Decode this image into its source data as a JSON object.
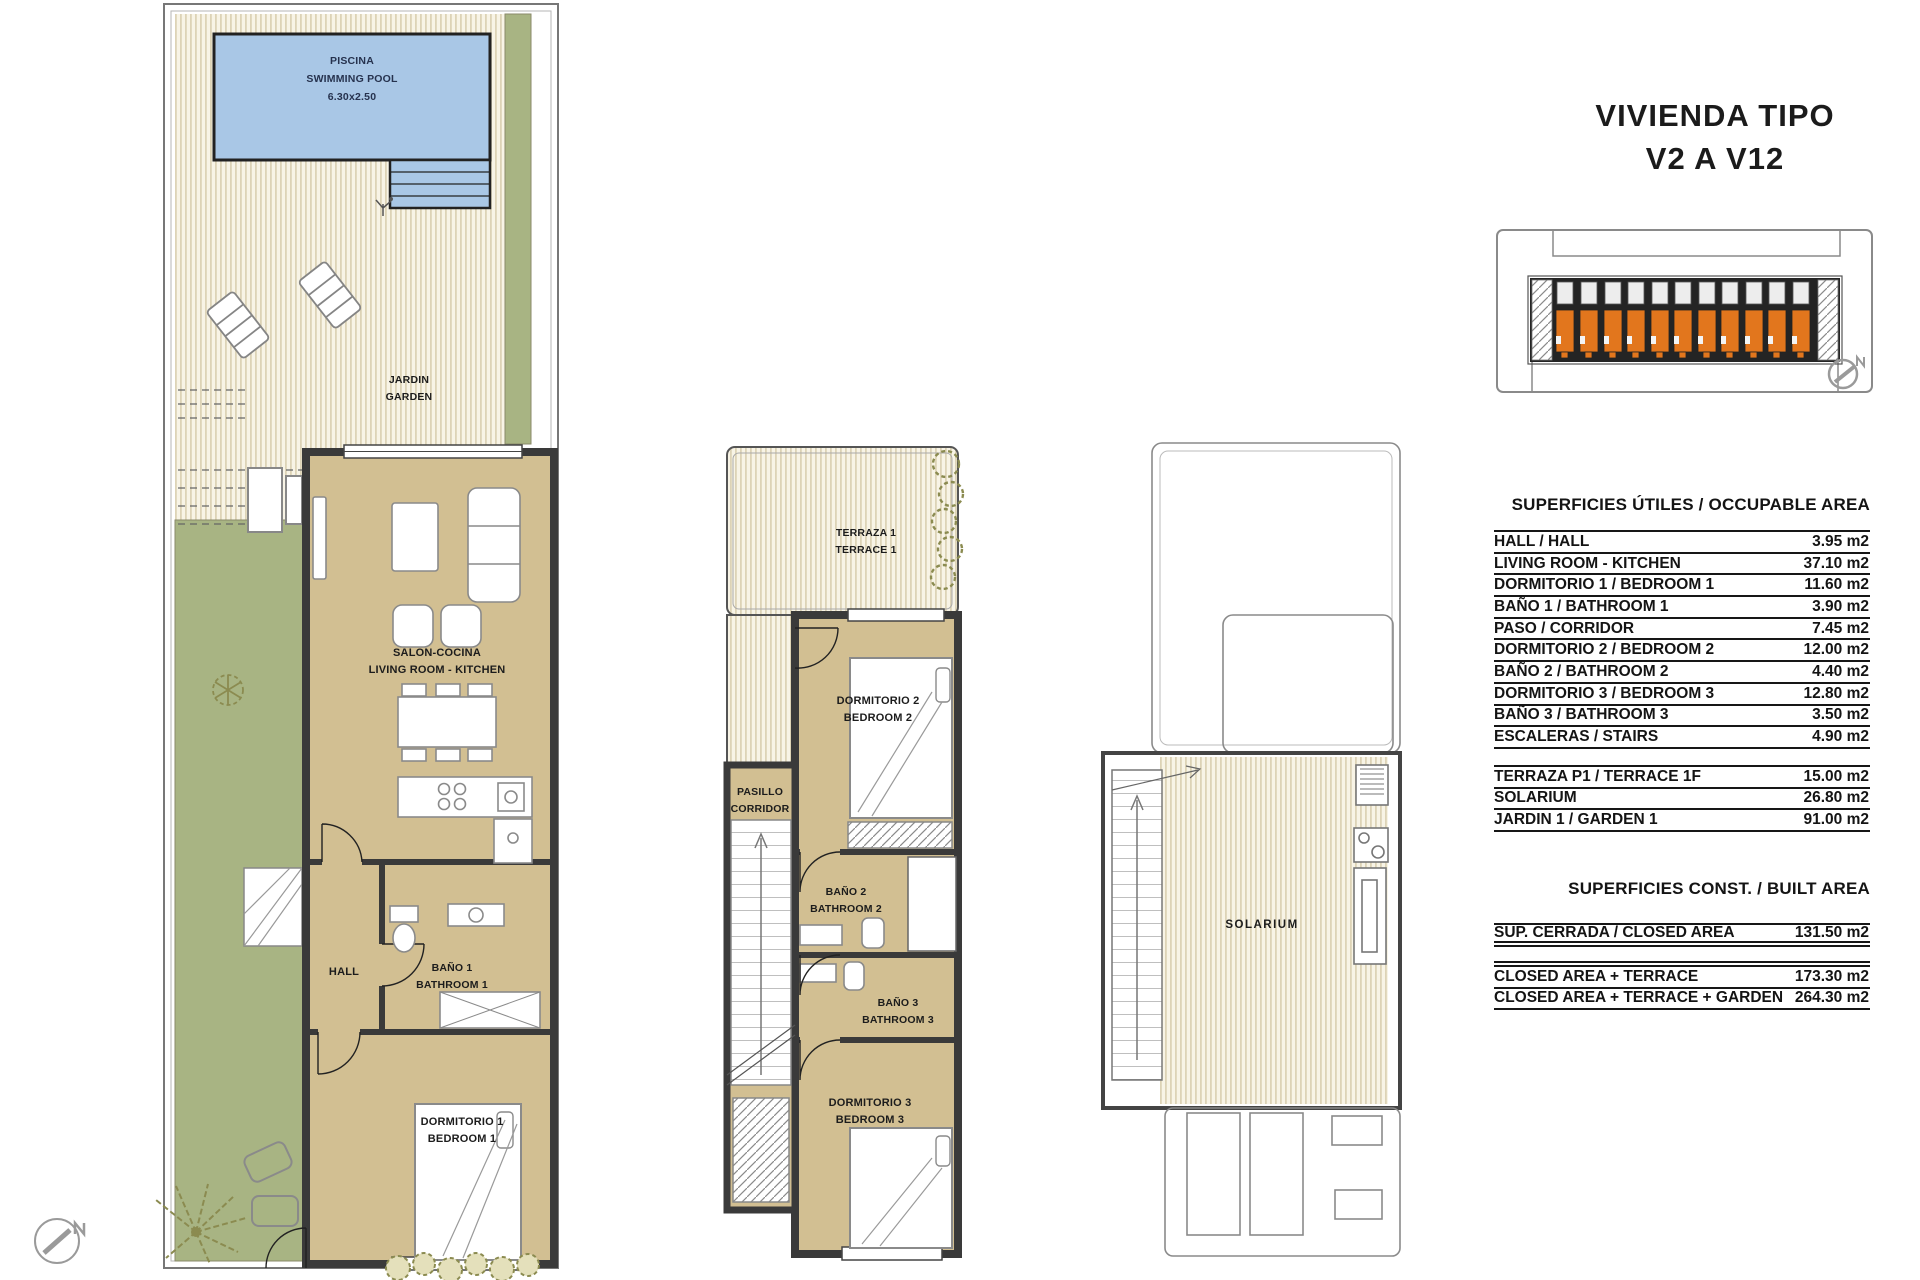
{
  "title": {
    "line1": "VIVIENDA TIPO",
    "line2": "V2 A V12"
  },
  "colors": {
    "floor_tan": "#d2bf92",
    "garden_green": "#a8b483",
    "stripe_cream": "#f8f4e6",
    "pool_blue": "#a9c7e6",
    "unit_orange": "#e2761d",
    "wall_dark": "#3a3a3a"
  },
  "plans": {
    "ground": {
      "pool": {
        "l1": "PISCINA",
        "l2": "SWIMMING POOL",
        "l3": "6.30x2.50"
      },
      "garden": {
        "l1": "JARDIN",
        "l2": "GARDEN"
      },
      "living": {
        "l1": "SALON-COCINA",
        "l2": "LIVING ROOM - KITCHEN"
      },
      "hall": "HALL",
      "bath1": {
        "l1": "BAÑO 1",
        "l2": "BATHROOM 1"
      },
      "bedroom1": {
        "l1": "DORMITORIO 1",
        "l2": "BEDROOM 1"
      }
    },
    "first": {
      "terrace": {
        "l1": "TERRAZA 1",
        "l2": "TERRACE 1"
      },
      "corridor": {
        "l1": "PASILLO",
        "l2": "CORRIDOR"
      },
      "bedroom2": {
        "l1": "DORMITORIO 2",
        "l2": "BEDROOM 2"
      },
      "bath2": {
        "l1": "BAÑO 2",
        "l2": "BATHROOM 2"
      },
      "bath3": {
        "l1": "BAÑO 3",
        "l2": "BATHROOM 3"
      },
      "bedroom3": {
        "l1": "DORMITORIO 3",
        "l2": "BEDROOM 3"
      }
    },
    "solarium": {
      "label": "SOLARIUM"
    }
  },
  "tables": {
    "occupable": {
      "heading": "SUPERFICIES ÚTILES / OCCUPABLE AREA",
      "rows": [
        {
          "label": "HALL / HALL",
          "value": "3.95 m2"
        },
        {
          "label": "LIVING ROOM - KITCHEN",
          "value": "37.10 m2"
        },
        {
          "label": "DORMITORIO 1 /  BEDROOM 1",
          "value": "11.60 m2"
        },
        {
          "label": "BAÑO 1 / BATHROOM 1",
          "value": "3.90 m2"
        },
        {
          "label": "PASO / CORRIDOR",
          "value": "7.45 m2"
        },
        {
          "label": "DORMITORIO 2 / BEDROOM 2",
          "value": "12.00 m2"
        },
        {
          "label": "BAÑO 2 / BATHROOM 2",
          "value": "4.40 m2"
        },
        {
          "label": "DORMITORIO 3 / BEDROOM 3",
          "value": "12.80 m2"
        },
        {
          "label": "BAÑO 3 / BATHROOM 3",
          "value": "3.50 m2"
        },
        {
          "label": "ESCALERAS / STAIRS",
          "value": "4.90 m2"
        }
      ]
    },
    "exterior": {
      "rows": [
        {
          "label": "TERRAZA P1 / TERRACE 1F",
          "value": "15.00 m2"
        },
        {
          "label": "SOLARIUM",
          "value": "26.80 m2"
        },
        {
          "label": "JARDIN 1 / GARDEN 1",
          "value": "91.00 m2"
        }
      ]
    },
    "built": {
      "heading": "SUPERFICIES  CONST. / BUILT AREA",
      "rows": [
        {
          "label": "SUP. CERRADA / CLOSED AREA",
          "value": "131.50 m2"
        }
      ]
    },
    "totals": {
      "rows": [
        {
          "label": "CLOSED AREA + TERRACE",
          "value": "173.30 m2"
        },
        {
          "label": "CLOSED AREA + TERRACE + GARDEN",
          "value": "264.30 m2"
        }
      ]
    }
  }
}
